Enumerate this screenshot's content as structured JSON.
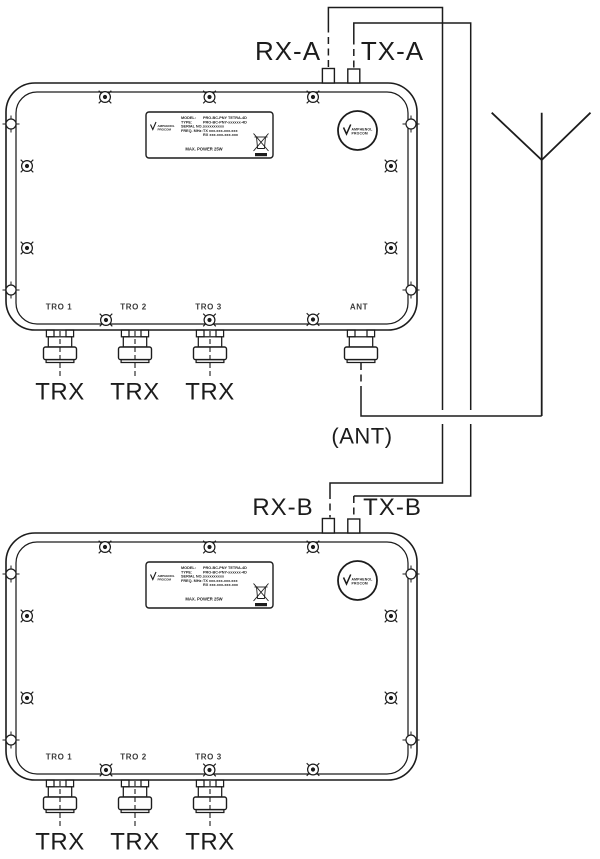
{
  "colors": {
    "ink": "#1c1c1c",
    "background": "#ffffff",
    "engraving": "#3a3a3a"
  },
  "top_unit": {
    "rx_port_label": "RX-A",
    "tx_port_label": "TX-A",
    "ant_port_label": "ANT"
  },
  "bottom_unit": {
    "rx_port_label": "RX-B",
    "tx_port_label": "TX-B"
  },
  "antenna_feed_label": "(ANT)",
  "unit": {
    "tro_port_1": "TRO 1",
    "tro_port_2": "TRO 2",
    "tro_port_3": "TRO 3",
    "trx_cable_label": "TRX",
    "logo": {
      "line1": "AMPHENOL",
      "line2": "PROCOM"
    },
    "nameplate": {
      "brand_line1": "AMPHENOL",
      "brand_line2": "PROCOM",
      "model_key": "MODEL:",
      "model_value": "PRO-BC-PNY TETRA-4D",
      "type_key": "TYPE:",
      "type_value": "PRO-BC-PNY-xxxxxx-4D",
      "serial_key": "SERIAL NO.:",
      "serial_value": "xxxxxxxxxx",
      "freq_key": "FREQ. MHz:",
      "freq_tx_value": "TX xxx.xxx-xxx.xxx",
      "freq_rx_value": "RX xxx.xxx-xxx.xxx",
      "footer": "MAX. POWER 25W"
    }
  }
}
